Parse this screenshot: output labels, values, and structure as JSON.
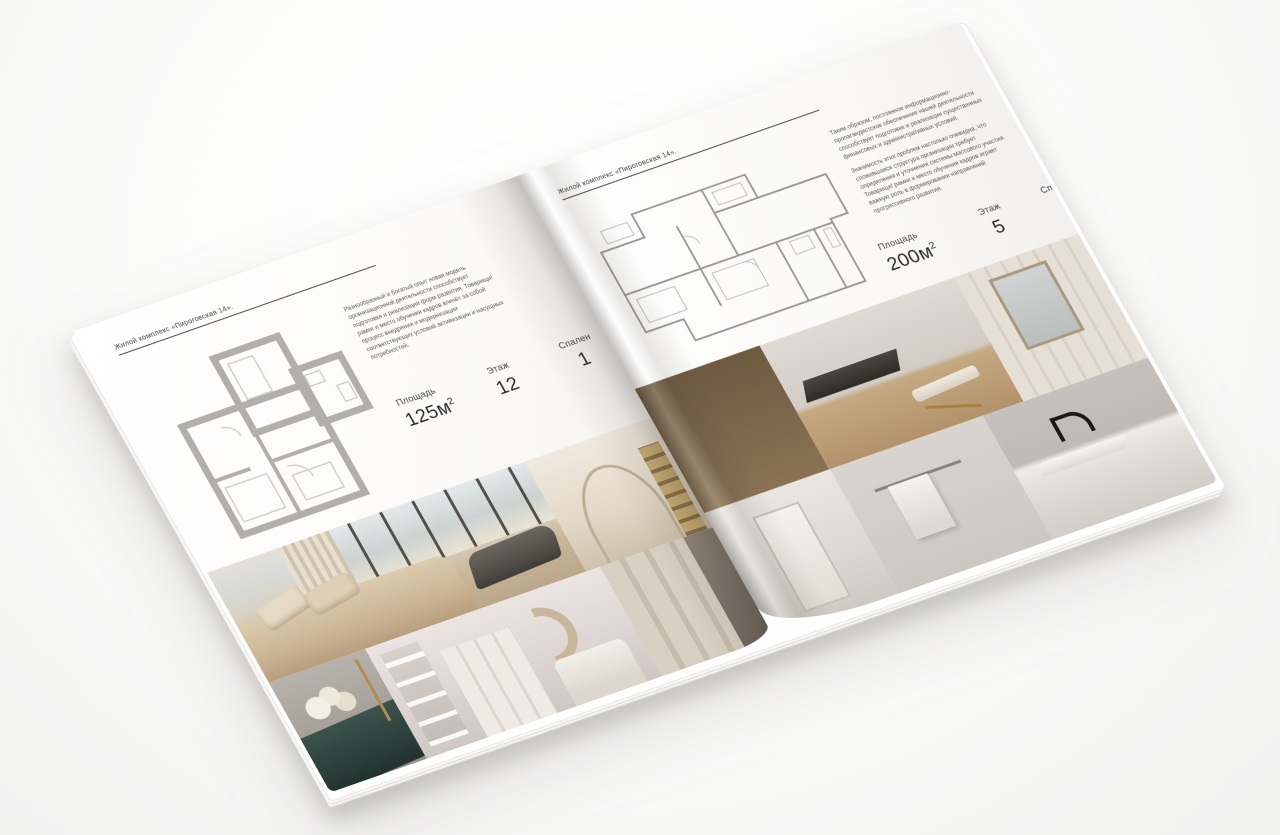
{
  "brochure": {
    "left_page": {
      "header": "Жилой комплекс «Пироговская 14».",
      "intro": "Разнообразный и богатый опыт новая модель организационной деятельности способствует подготовке и реализации форм развития. Товарищи! рамки и место обучения кадров влечёт за собой процесс внедрения и модернизации соответствующих условий активизации и насущных потребностей.",
      "stats": [
        {
          "label": "Площадь",
          "value": "125м",
          "sup": "2"
        },
        {
          "label": "Этаж",
          "value": "12",
          "sup": ""
        },
        {
          "label": "Спален",
          "value": "1",
          "sup": ""
        }
      ],
      "photos": [
        "bedroom-with-city-window-and-chaise",
        "hallway-arch-with-shelves",
        "teal-dresser-with-flowers",
        "bedroom-with-moon-wall-decor",
        "dressing-room-wardrobe"
      ]
    },
    "right_page": {
      "header": "Жилой комплекс «Пироговская 14».",
      "paragraph_1": "Таким образом, постоянное информационно-пропагандистское обеспечение нашей деятельности способствует подготовке и реализации существенных финансовых и административных условий.",
      "paragraph_2": "Значимость этих проблем настолько очевидна, что сложившаяся структура организации требует определения и уточнения системы массового участия. Товарищи! рамки и место обучения кадров играет важную роль в формировании направлений прогрессивного развития.",
      "stats": [
        {
          "label": "Площадь",
          "value": "200м",
          "sup": "2"
        },
        {
          "label": "Этаж",
          "value": "5",
          "sup": ""
        },
        {
          "label": "Спален",
          "value": "2",
          "sup": ""
        }
      ],
      "photos": [
        "amber-glass-cabinet",
        "study-with-wood-floor",
        "vanity-with-mirror",
        "white-corridor",
        "bathroom-towels",
        "marble-counter-black-faucet"
      ]
    },
    "colors": {
      "background": "#f7f7f6",
      "page": "#fbfaf8",
      "header_rule": "#4a4a4a",
      "text": "#3c3c3c",
      "plan_wall_thick": "#b2afaa",
      "plan_wall_thin": "#989691",
      "photo_beige": "#c9b79c",
      "photo_tan": "#b2926a",
      "photo_teal_dresser": "#2c403b",
      "photo_charcoal": "#504c45",
      "photo_amber_cabinet": "#b9925a"
    }
  }
}
